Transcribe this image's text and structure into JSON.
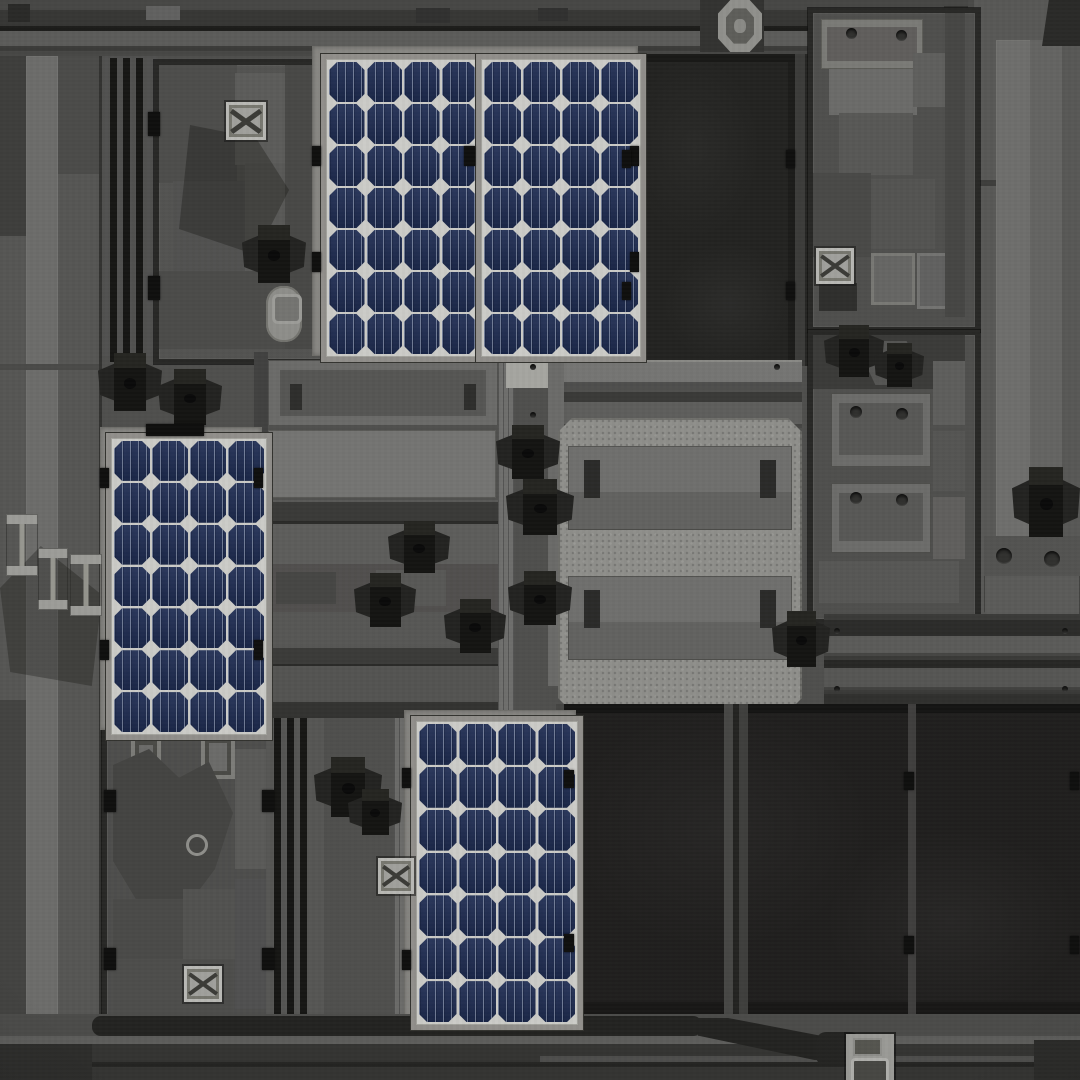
{
  "scene": {
    "type": "rooftop-texture-atlas",
    "description": "Top-down industrial rooftop texture with four photovoltaic solar panels, two black membrane roof slabs, three framed equipment sections, large pale HVAC units, scattered dark turbine roof vents, X-pattern hatch vents, striped service rails and perimeter walkway bands",
    "palette": {
      "base": "#4f4f4d",
      "frameDark": "#282826",
      "stripeBlack": "#161614",
      "lightCol": "#6c6c6a",
      "sectionBg": "#525250",
      "slabBlack": "#222220",
      "slabSeam": "#474745",
      "paleUnit": "#8f8f8b",
      "unitBand": "#6a6a68",
      "railLight": "#5b5b59",
      "railDark": "#2f2f2d",
      "ventFlap": "#232321",
      "ventBox": "#141412",
      "panelCell": "#1e2c52",
      "backsheet": "#cbcbc7",
      "panelFrame": "#918f8b",
      "mount": "#898884",
      "gutter": "#232321",
      "bandDark": "#373735",
      "bandLight": "#5c5c5a"
    },
    "solar_panels": [
      {
        "id": "top-left",
        "x": 321,
        "y": 54,
        "w": 148,
        "h": 292,
        "cols": 4,
        "rows": 7
      },
      {
        "id": "top-right",
        "x": 476,
        "y": 54,
        "w": 154,
        "h": 292,
        "cols": 4,
        "rows": 7
      },
      {
        "id": "mid-left",
        "x": 106,
        "y": 433,
        "w": 150,
        "h": 291,
        "cols": 4,
        "rows": 7
      },
      {
        "id": "bottom-center",
        "x": 411,
        "y": 716,
        "w": 156,
        "h": 298,
        "cols": 4,
        "rows": 7
      }
    ],
    "objects": {
      "roof_vents": [
        [
          98,
          352,
          64,
          60
        ],
        [
          158,
          368,
          64,
          58
        ],
        [
          242,
          224,
          64,
          60
        ],
        [
          496,
          424,
          64,
          56
        ],
        [
          506,
          478,
          68,
          58
        ],
        [
          388,
          520,
          62,
          54
        ],
        [
          354,
          572,
          62,
          56
        ],
        [
          444,
          598,
          62,
          56
        ],
        [
          508,
          570,
          64,
          56
        ],
        [
          314,
          756,
          68,
          62
        ],
        [
          348,
          788,
          54,
          48
        ],
        [
          824,
          324,
          60,
          54
        ],
        [
          874,
          342,
          50,
          46
        ],
        [
          772,
          610,
          58,
          58
        ],
        [
          1012,
          466,
          68,
          72
        ]
      ],
      "x_vents": [
        [
          226,
          102,
          40,
          38
        ],
        [
          816,
          248,
          38,
          36
        ],
        [
          184,
          966,
          38,
          36
        ],
        [
          378,
          858,
          36,
          36
        ]
      ],
      "clips": [
        [
          312,
          146,
          9,
          20
        ],
        [
          312,
          252,
          9,
          20
        ],
        [
          464,
          146,
          11,
          20
        ],
        [
          630,
          146,
          9,
          20
        ],
        [
          630,
          252,
          9,
          20
        ],
        [
          622,
          150,
          9,
          18
        ],
        [
          622,
          282,
          9,
          18
        ],
        [
          786,
          150,
          9,
          18
        ],
        [
          786,
          282,
          9,
          18
        ],
        [
          148,
          112,
          12,
          24
        ],
        [
          148,
          276,
          12,
          24
        ],
        [
          100,
          468,
          9,
          20
        ],
        [
          100,
          640,
          9,
          20
        ],
        [
          254,
          468,
          9,
          20
        ],
        [
          254,
          640,
          9,
          20
        ],
        [
          402,
          768,
          9,
          20
        ],
        [
          402,
          950,
          9,
          20
        ],
        [
          564,
          770,
          10,
          18
        ],
        [
          564,
          934,
          10,
          18
        ],
        [
          904,
          772,
          10,
          18
        ],
        [
          904,
          936,
          10,
          18
        ],
        [
          1070,
          772,
          9,
          18
        ],
        [
          1070,
          936,
          9,
          18
        ],
        [
          104,
          790,
          12,
          22
        ],
        [
          104,
          948,
          12,
          22
        ],
        [
          262,
          790,
          12,
          22
        ],
        [
          262,
          948,
          12,
          22
        ],
        [
          146,
          424,
          58,
          12
        ]
      ],
      "bolts": [
        [
          846,
          28,
          11,
          0
        ],
        [
          896,
          30,
          11,
          0
        ],
        [
          850,
          406,
          12,
          0
        ],
        [
          896,
          408,
          12,
          0
        ],
        [
          850,
          492,
          12,
          0
        ],
        [
          896,
          494,
          12,
          0
        ],
        [
          996,
          548,
          16,
          0
        ],
        [
          1044,
          551,
          16,
          0
        ],
        [
          186,
          834,
          16,
          1
        ],
        [
          530,
          364,
          6,
          0
        ],
        [
          774,
          364,
          6,
          0
        ],
        [
          530,
          412,
          6,
          0
        ],
        [
          834,
          628,
          6,
          0
        ],
        [
          1062,
          628,
          6,
          0
        ],
        [
          834,
          686,
          6,
          0
        ],
        [
          1062,
          686,
          6,
          0
        ]
      ],
      "ibeams": [
        [
          6,
          514,
          32,
          62
        ],
        [
          38,
          548,
          30,
          62
        ],
        [
          70,
          554,
          32,
          62
        ]
      ]
    },
    "counts": {
      "solar_panels": 4,
      "roof_vents": 15,
      "x_vents": 4,
      "hvac_band_units": 2,
      "black_roof_slabs": 2,
      "framed_sections": 3
    }
  }
}
